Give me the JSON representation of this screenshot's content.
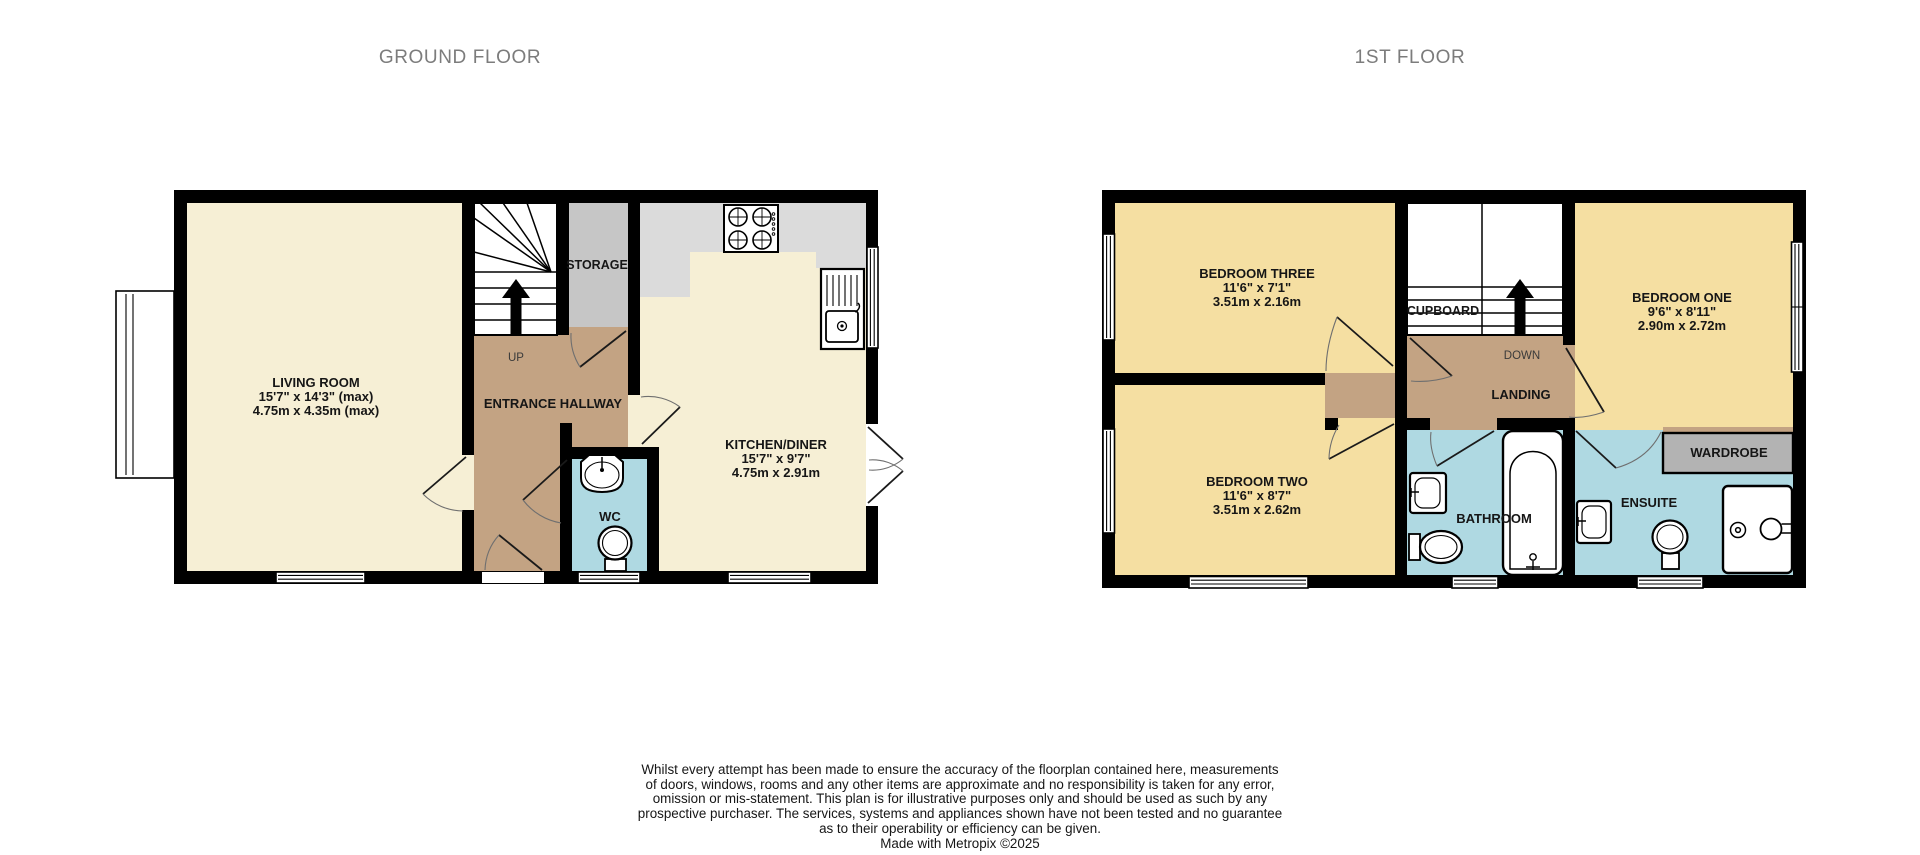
{
  "titles": {
    "ground_floor": "GROUND FLOOR",
    "first_floor": "1ST FLOOR"
  },
  "colors": {
    "wall": "#000000",
    "living_kitchen_floor": "#F6EFD5",
    "bedroom_floor": "#F5DFA2",
    "hallway_landing_floor": "#C3A383",
    "bathroom_floor": "#AFD9E2",
    "storage_gray": "#C6C6C6",
    "counter_gray": "#DBDBDB",
    "wardrobe_gray": "#B3B3B3",
    "title_text": "#7C7C7C",
    "label_text": "#161616"
  },
  "ground_floor": {
    "living_room": {
      "name": "LIVING ROOM",
      "size_imperial": "15'7\" x 14'3\" (max)",
      "size_metric": "4.75m x 4.35m (max)"
    },
    "kitchen_diner": {
      "name": "KITCHEN/DINER",
      "size_imperial": "15'7\" x 9'7\"",
      "size_metric": "4.75m x 2.91m"
    },
    "entrance_hallway": {
      "name": "ENTRANCE HALLWAY"
    },
    "storage": {
      "name": "STORAGE"
    },
    "wc": {
      "name": "WC"
    },
    "stairs": {
      "direction": "UP"
    }
  },
  "first_floor": {
    "bedroom_three": {
      "name": "BEDROOM THREE",
      "size_imperial": "11'6\" x 7'1\"",
      "size_metric": "3.51m x 2.16m"
    },
    "bedroom_one": {
      "name": "BEDROOM ONE",
      "size_imperial": "9'6\" x 8'11\"",
      "size_metric": "2.90m x 2.72m"
    },
    "bedroom_two": {
      "name": "BEDROOM TWO",
      "size_imperial": "11'6\" x 8'7\"",
      "size_metric": "3.51m x 2.62m"
    },
    "cupboard": {
      "name": "CUPBOARD"
    },
    "landing": {
      "name": "LANDING"
    },
    "bathroom": {
      "name": "BATHROOM"
    },
    "ensuite": {
      "name": "ENSUITE"
    },
    "wardrobe": {
      "name": "WARDROBE"
    },
    "stairs": {
      "direction": "DOWN"
    }
  },
  "footer": {
    "disclaimer_lines": [
      "Whilst every attempt has been made to ensure the accuracy of the floorplan contained here, measurements",
      "of doors, windows, rooms and any other items are approximate and no responsibility is taken for any error,",
      "omission or mis-statement. This plan is for illustrative purposes only and should be used as such by any",
      "prospective purchaser. The services, systems and appliances shown have not been tested and no guarantee",
      "as to their operability or efficiency can be given."
    ],
    "credit": "Made with Metropix ©2025"
  }
}
